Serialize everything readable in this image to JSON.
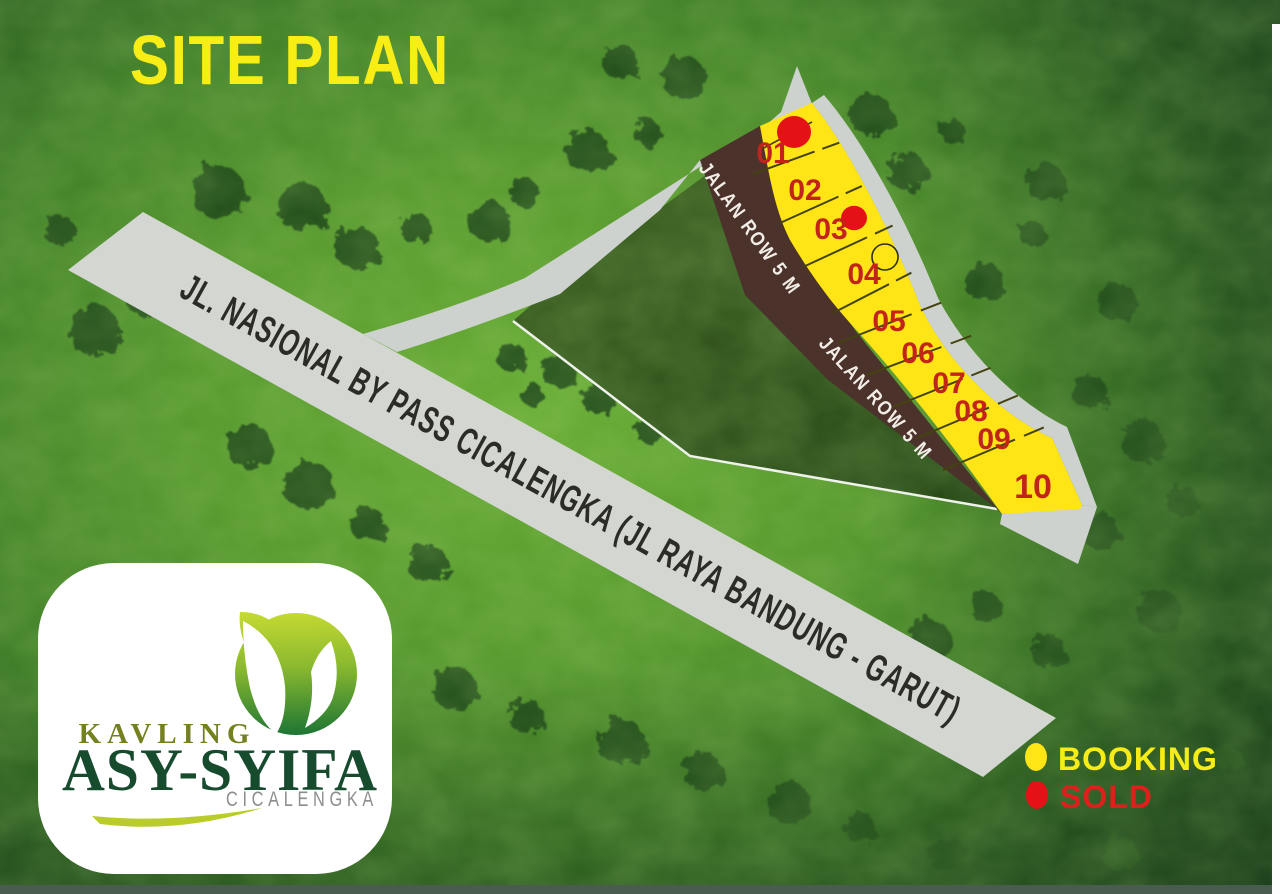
{
  "title": "SITE PLAN",
  "roads": {
    "main_label": "JL. NASIONAL BY PASS CICALENGKA (JL RAYA BANDUNG - GARUT)",
    "row_label": "JALAN ROW 5 M"
  },
  "legend": {
    "items": [
      {
        "label": "BOOKING",
        "dot_color": "#ffe515",
        "text_color": "#f7ec15"
      },
      {
        "label": "SOLD",
        "dot_color": "#e41217",
        "text_color": "#de201c"
      }
    ]
  },
  "logo": {
    "top": "KAVLING",
    "name": "ASY-SYIFA",
    "sub": "CICALENGKA"
  },
  "plots": [
    {
      "num": "01",
      "x": 773,
      "y": 163,
      "status": "sold",
      "mx": 794,
      "my": 132,
      "mr": 17
    },
    {
      "num": "02",
      "x": 805,
      "y": 200,
      "status": null
    },
    {
      "num": "03",
      "x": 831,
      "y": 239,
      "status": "sold",
      "mx": 854,
      "my": 218,
      "mr": 13
    },
    {
      "num": "04",
      "x": 864,
      "y": 284,
      "status": "booking",
      "mx": 885,
      "my": 257,
      "mr": 13
    },
    {
      "num": "05",
      "x": 889,
      "y": 331,
      "status": null
    },
    {
      "num": "06",
      "x": 918,
      "y": 363,
      "status": null
    },
    {
      "num": "07",
      "x": 949,
      "y": 393,
      "status": null
    },
    {
      "num": "08",
      "x": 971,
      "y": 421,
      "status": null
    },
    {
      "num": "09",
      "x": 994,
      "y": 449,
      "status": null
    },
    {
      "num": "10",
      "x": 1033,
      "y": 498,
      "status": null,
      "big": true
    }
  ],
  "dividers": [
    [
      753,
      174,
      830,
      146
    ],
    [
      780,
      223,
      853,
      190
    ],
    [
      803,
      267,
      883,
      230
    ],
    [
      833,
      313,
      903,
      277
    ],
    [
      838,
      343,
      930,
      307
    ],
    [
      867,
      375,
      960,
      340
    ],
    [
      893,
      407,
      980,
      372
    ],
    [
      917,
      438,
      1007,
      400
    ],
    [
      943,
      470,
      1033,
      432
    ]
  ],
  "trees": [
    [
      218,
      191,
      26
    ],
    [
      302,
      206,
      24
    ],
    [
      357,
      247,
      21
    ],
    [
      416,
      228,
      15
    ],
    [
      489,
      221,
      20
    ],
    [
      524,
      192,
      14
    ],
    [
      588,
      151,
      21
    ],
    [
      621,
      62,
      17
    ],
    [
      684,
      77,
      21
    ],
    [
      648,
      133,
      13
    ],
    [
      95,
      331,
      25
    ],
    [
      142,
      301,
      14
    ],
    [
      60,
      230,
      15
    ],
    [
      871,
      114,
      21
    ],
    [
      907,
      171,
      19
    ],
    [
      952,
      131,
      12
    ],
    [
      1046,
      182,
      19
    ],
    [
      984,
      281,
      19
    ],
    [
      1033,
      234,
      13
    ],
    [
      1117,
      301,
      19
    ],
    [
      1090,
      391,
      17
    ],
    [
      1143,
      441,
      21
    ],
    [
      1183,
      501,
      15
    ],
    [
      1101,
      531,
      18
    ],
    [
      1160,
      611,
      21
    ],
    [
      1049,
      651,
      17
    ],
    [
      930,
      640,
      21
    ],
    [
      986,
      607,
      15
    ],
    [
      512,
      357,
      14
    ],
    [
      558,
      371,
      16
    ],
    [
      532,
      394,
      11
    ],
    [
      598,
      399,
      15
    ],
    [
      648,
      431,
      12
    ],
    [
      250,
      446,
      22
    ],
    [
      308,
      484,
      24
    ],
    [
      368,
      524,
      17
    ],
    [
      428,
      563,
      19
    ],
    [
      455,
      688,
      21
    ],
    [
      527,
      716,
      17
    ],
    [
      621,
      741,
      23
    ],
    [
      703,
      771,
      19
    ],
    [
      789,
      803,
      21
    ],
    [
      860,
      827,
      15
    ],
    [
      948,
      855,
      18
    ],
    [
      1120,
      853,
      17
    ],
    [
      1228,
      758,
      13
    ]
  ],
  "colors": {
    "plot_yellow": "#ffe515",
    "sold": "#e41217",
    "booking_stroke": "#2f2f1f",
    "tree": "#1d4717",
    "divider": "#43430f",
    "title": "#f8ee16",
    "road_gray": "#d4d6d2",
    "brown_road": "#4b322b",
    "plot_number_red": "#c2241a"
  }
}
